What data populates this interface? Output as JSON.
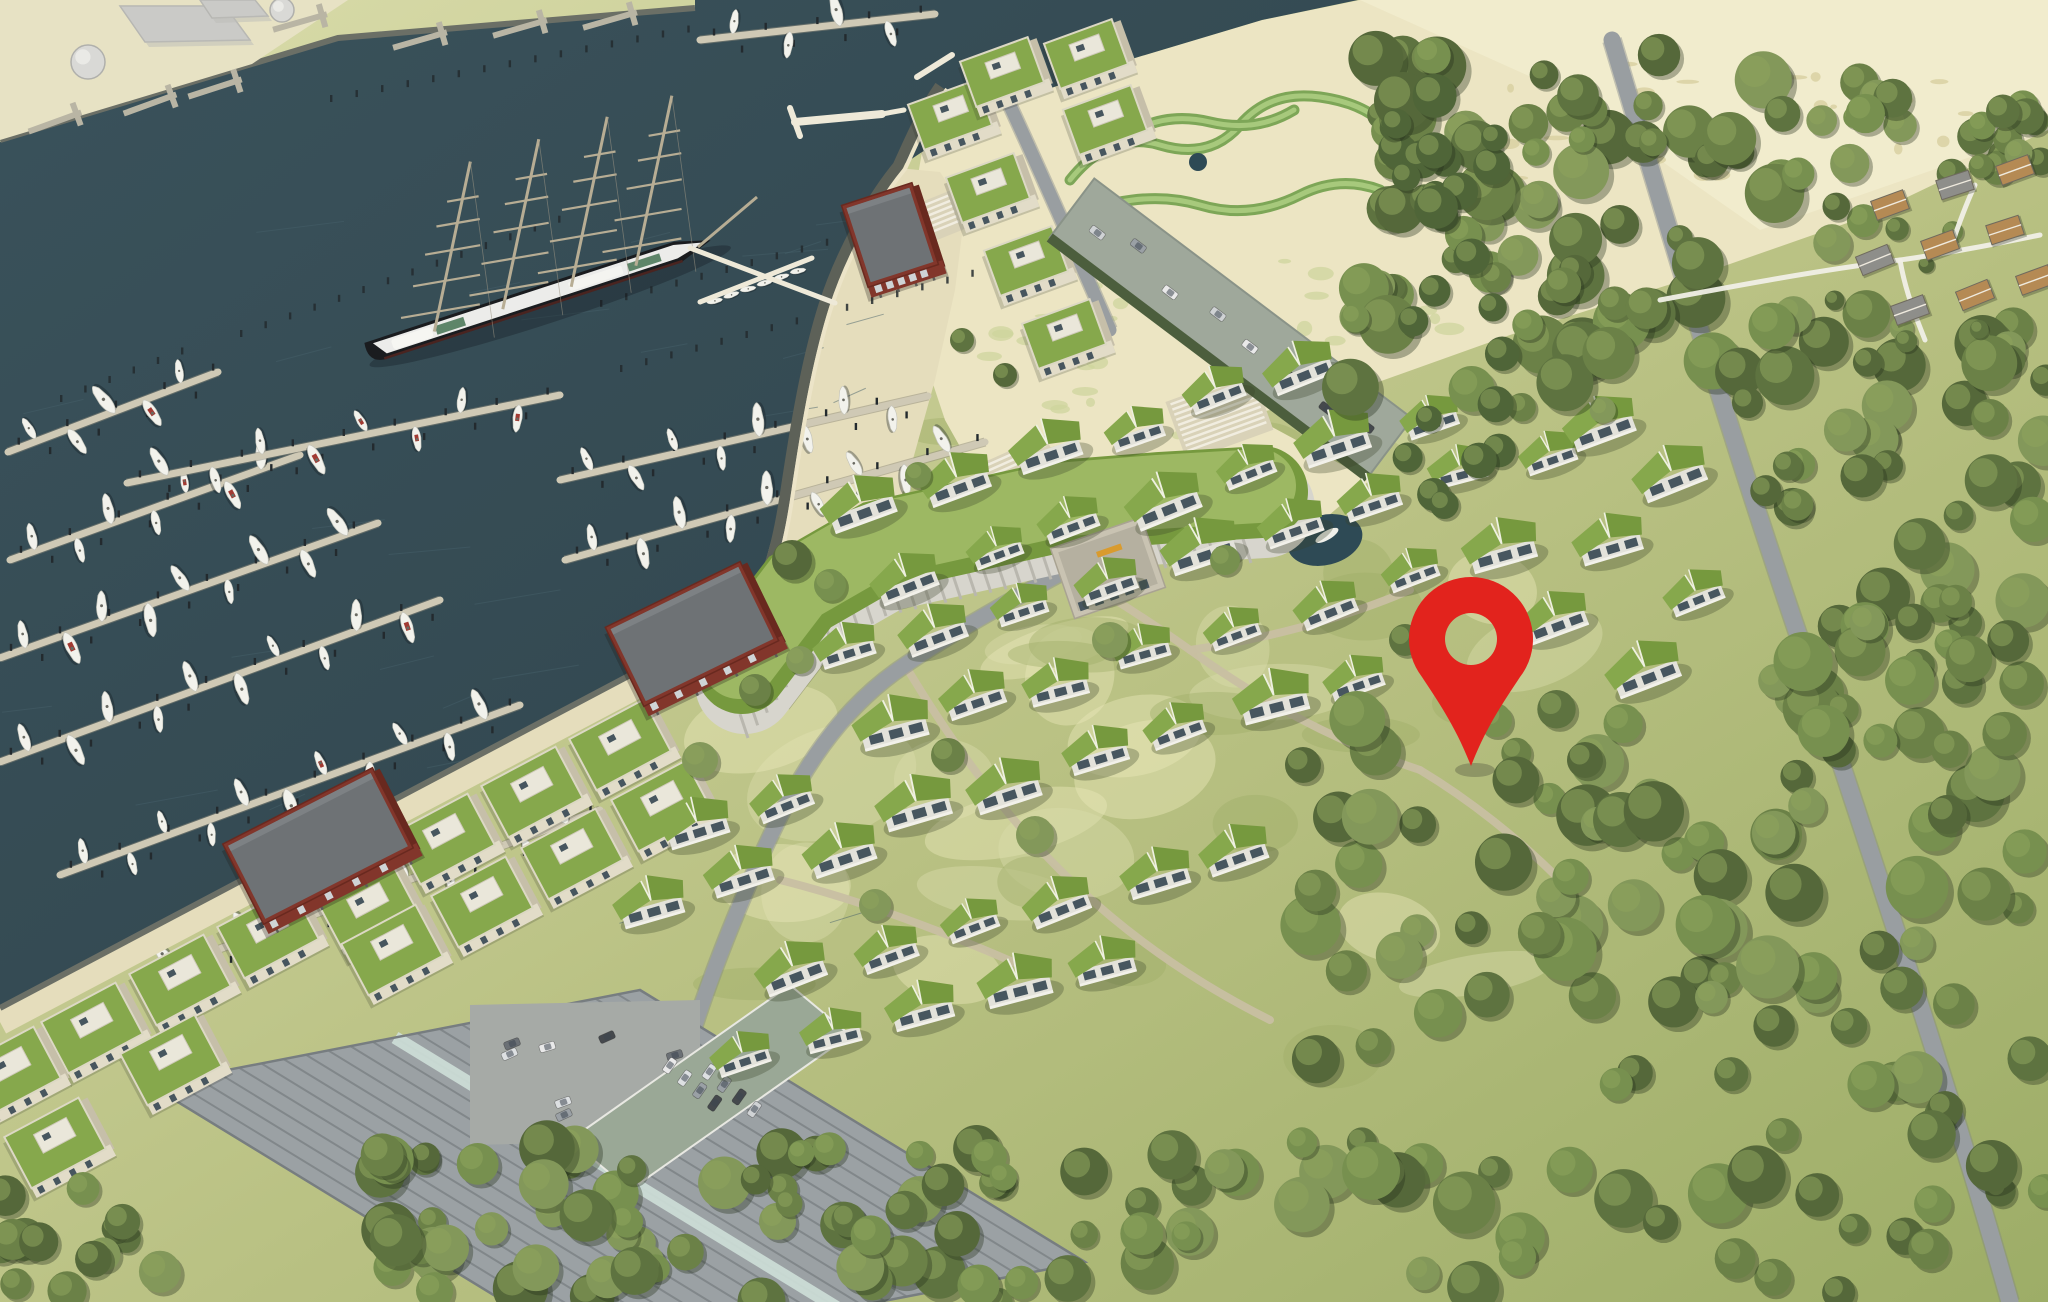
{
  "meta": {
    "canvas": {
      "w": 2048,
      "h": 1302
    },
    "view": "aerial-site-plan-rendering"
  },
  "palette": {
    "water": "#3a525b",
    "water_deep": "#30444c",
    "sand": "#ece5c3",
    "sand_bright": "#f3edcf",
    "quay": "#e7e2c4",
    "meadow": "#b9c183",
    "meadow_light": "#dadcab",
    "meadow_dark": "#9dad67",
    "forest": [
      "#5e7340",
      "#6b8147",
      "#77904f",
      "#55683a",
      "#83985a"
    ],
    "poplar": "#4f6538",
    "roof_green": "#86a84c",
    "roof_green2": "#76993e",
    "wall_front": "#e2dcc8",
    "wall_side": "#c6bfa9",
    "penthouse": "#eae7da",
    "window": "#47565f",
    "brick": "#82362b",
    "brick_dark": "#69291f",
    "brick_roof": "#6e7275",
    "pontoon": "#cfc9b5",
    "pile": "#232a2e",
    "boat": "#f2f2ec",
    "boat_accent": "#a23a32",
    "promenade": "#e5ddbc",
    "seawall": "#5d6158",
    "edge_white": "#ece4c8",
    "road": "#999ea1",
    "path": "#c8bfa2",
    "hall_roof": "#9ba1a4",
    "hall_rib": "#81878a",
    "skylight": "#cfe0d9",
    "lot": "#a6aaa6",
    "deck": "#9aa896",
    "car": [
      "#e9e9e9",
      "#cfd2d4",
      "#9aa0a5",
      "#6b7075",
      "#45494d",
      "#dde0e2"
    ],
    "pin": "#e2231d",
    "ship_hull": "#1a1c1f",
    "ship_deck": "#ececea",
    "ship_green": "#5e8569",
    "mast": "#b7ad94",
    "pond": "#2e4a55",
    "deck_blue": "#5b87a8",
    "deck_blue2": "#8fb6d2",
    "sign": "#d99b2e",
    "tank": "#d9d9d6",
    "cottage_tan": "#b58a54",
    "cottage_gray": "#8e8e8a",
    "white_path": "#f0efe6"
  },
  "scene": {
    "seed": 1337,
    "water_polygon": [
      [
        0,
        142
      ],
      [
        338,
        38
      ],
      [
        695,
        8
      ],
      [
        695,
        0
      ],
      [
        1358,
        0
      ],
      [
        1262,
        20
      ],
      [
        1135,
        58
      ],
      [
        1012,
        102
      ],
      [
        922,
        152
      ],
      [
        898,
        168
      ],
      [
        862,
        216
      ],
      [
        830,
        290
      ],
      [
        808,
        368
      ],
      [
        792,
        442
      ],
      [
        778,
        516
      ],
      [
        760,
        582
      ],
      [
        742,
        614
      ],
      [
        0,
        1008
      ]
    ],
    "quay_polygon": [
      [
        0,
        0
      ],
      [
        348,
        0
      ],
      [
        252,
        64
      ],
      [
        0,
        140
      ]
    ],
    "beach_polygon": [
      [
        905,
        250
      ],
      [
        922,
        152
      ],
      [
        1012,
        102
      ],
      [
        1135,
        58
      ],
      [
        1262,
        20
      ],
      [
        1360,
        0
      ],
      [
        2048,
        0
      ],
      [
        2048,
        130
      ],
      [
        1870,
        215
      ],
      [
        1690,
        278
      ],
      [
        1510,
        335
      ],
      [
        1370,
        385
      ],
      [
        1250,
        415
      ],
      [
        1370,
        480
      ],
      [
        1300,
        540
      ],
      [
        1200,
        560
      ],
      [
        1080,
        540
      ],
      [
        990,
        500
      ],
      [
        945,
        420
      ],
      [
        915,
        330
      ]
    ],
    "plaza_polygon": [
      [
        898,
        168
      ],
      [
        862,
        216
      ],
      [
        830,
        290
      ],
      [
        808,
        368
      ],
      [
        792,
        442
      ],
      [
        778,
        516
      ],
      [
        760,
        582
      ],
      [
        742,
        618
      ],
      [
        830,
        645
      ],
      [
        880,
        560
      ],
      [
        910,
        470
      ],
      [
        935,
        380
      ],
      [
        955,
        290
      ],
      [
        965,
        210
      ],
      [
        940,
        172
      ]
    ],
    "seawall_path": "M940,86 C920,115 910,140 898,166 C870,200 840,255 824,305 C806,362 795,430 786,490 C778,545 768,585 742,616",
    "quay_edge": {
      "x1": 742,
      "y1": 616,
      "x2": 0,
      "y2": 1008
    },
    "top_quay_edge": "M0,140 L338,38 L695,8",
    "pontoons": [
      {
        "x1": 8,
        "y1": 452,
        "x2": 218,
        "y2": 372,
        "boats": 5
      },
      {
        "x1": 10,
        "y1": 560,
        "x2": 300,
        "y2": 455,
        "boats": 7
      },
      {
        "x1": 0,
        "y1": 658,
        "x2": 378,
        "y2": 523,
        "boats": 9
      },
      {
        "x1": 0,
        "y1": 762,
        "x2": 440,
        "y2": 600,
        "boats": 10
      },
      {
        "x1": 60,
        "y1": 875,
        "x2": 520,
        "y2": 705,
        "boats": 11
      },
      {
        "x1": 140,
        "y1": 978,
        "x2": 600,
        "y2": 810,
        "boats": 11
      },
      {
        "x1": 127,
        "y1": 483,
        "x2": 560,
        "y2": 395,
        "boats": 8
      },
      {
        "x1": 560,
        "y1": 480,
        "x2": 928,
        "y2": 396,
        "boats": 8
      },
      {
        "x1": 565,
        "y1": 560,
        "x2": 985,
        "y2": 442,
        "boats": 9
      },
      {
        "x1": 618,
        "y1": 692,
        "x2": 930,
        "y2": 515,
        "boats": 7
      },
      {
        "x1": 700,
        "y1": 40,
        "x2": 935,
        "y2": 14,
        "boats": 4
      }
    ],
    "pile_rows": [
      [
        240,
        330,
        560,
        215
      ],
      [
        600,
        300,
        950,
        205
      ],
      [
        620,
        365,
        1000,
        262
      ],
      [
        60,
        395,
        200,
        340
      ],
      [
        330,
        95,
        690,
        25
      ]
    ],
    "piers": [
      {
        "x1": 795,
        "y1": 122,
        "x2": 882,
        "y2": 114,
        "w": 8
      },
      {
        "x1": 790,
        "y1": 108,
        "x2": 800,
        "y2": 136,
        "w": 6
      },
      {
        "x1": 882,
        "y1": 114,
        "x2": 904,
        "y2": 110,
        "w": 5
      },
      {
        "x1": 917,
        "y1": 77,
        "x2": 952,
        "y2": 55,
        "w": 6
      },
      {
        "x1": 835,
        "y1": 303,
        "x2": 690,
        "y2": 248,
        "w": 5
      },
      {
        "x1": 700,
        "y1": 302,
        "x2": 812,
        "y2": 258,
        "w": 5
      }
    ],
    "quay_docks": [
      [
        55,
        122,
        -20
      ],
      [
        150,
        104,
        -20
      ],
      [
        215,
        88,
        -18
      ],
      [
        300,
        22,
        -16
      ],
      [
        420,
        40,
        -16
      ],
      [
        520,
        28,
        -16
      ],
      [
        610,
        20,
        -16
      ]
    ],
    "ship": {
      "cx": 537,
      "cy": 298,
      "rot": -18.1,
      "len": 360,
      "beam": 26,
      "mast_x": [
        -108,
        -36,
        36,
        104
      ],
      "mast_lean": [
        36,
        -170
      ],
      "yard_fracs": [
        0.12,
        0.3,
        0.48,
        0.64,
        0.78
      ],
      "yard_half": [
        40,
        34,
        28,
        22,
        16
      ],
      "bowsprit": [
        [
          698,
          247
        ],
        [
          757,
          197
        ]
      ]
    },
    "dinghies": {
      "x1": 706,
      "y1": 296,
      "x2": 806,
      "y2": 260,
      "n": 6
    },
    "head_blocks": [
      [
        950,
        115
      ],
      [
        988,
        188
      ],
      [
        1026,
        261
      ],
      [
        1064,
        334
      ],
      [
        1002,
        72
      ],
      [
        1086,
        54
      ],
      [
        1105,
        120
      ]
    ],
    "garage": {
      "a": [
        1072,
        208
      ],
      "b": [
        1390,
        448
      ],
      "w": 74,
      "cars": 8
    },
    "park_ribbons": [
      "M1070,180 q40,-50 90,-35 q50,15 80,-20 q30,-35 80,-28 q50,7 70,35",
      "M1090,210 q60,-20 110,-5 q50,15 100,-10 q40,-20 80,-5",
      "M1120,140 q40,-30 90,-18 q46,11 84,-12"
    ],
    "park_pond": [
      1198,
      162,
      9
    ],
    "hotel": {
      "spine": [
        [
          742,
          668
        ],
        [
          800,
          592
        ],
        [
          880,
          546
        ],
        [
          970,
          526
        ],
        [
          1060,
          506
        ],
        [
          1160,
          498
        ],
        [
          1262,
          492
        ]
      ],
      "tower": {
        "x": 1108,
        "y": 568,
        "w": 96,
        "h": 74,
        "rot": -19
      },
      "sign": {
        "x": 1096,
        "y": 552,
        "w": 26,
        "h": 6,
        "rot": -19
      }
    },
    "pond": {
      "x": 1325,
      "y": 540,
      "rx": 38,
      "ry": 25,
      "rot": -14
    },
    "blue_deck": {
      "x": 1232,
      "y": 542,
      "n": 6,
      "rot": -22
    },
    "stairs": [
      {
        "x": 1010,
        "y": 455,
        "rot": -24,
        "n": 8,
        "len": 72
      },
      {
        "x": 1210,
        "y": 390,
        "rot": -20,
        "n": 10,
        "len": 84
      },
      {
        "x": 925,
        "y": 205,
        "rot": -22,
        "n": 6,
        "len": 50
      }
    ],
    "quay_blocks": [
      [
        620,
        745
      ],
      [
        532,
        792
      ],
      [
        444,
        839
      ],
      [
        368,
        908
      ],
      [
        268,
        933
      ],
      [
        180,
        980
      ],
      [
        92,
        1028
      ],
      [
        10,
        1072
      ],
      [
        662,
        806
      ],
      [
        572,
        854
      ],
      [
        482,
        902
      ],
      [
        392,
        950
      ],
      [
        171,
        1060
      ],
      [
        55,
        1143
      ]
    ],
    "red_buildings": [
      {
        "x": 890,
        "y": 235,
        "w": 74,
        "h": 86,
        "rot": -18,
        "stilts": true
      },
      {
        "x": 692,
        "y": 634,
        "w": 150,
        "h": 88,
        "rot": -26,
        "stilts": true
      },
      {
        "x": 318,
        "y": 846,
        "w": 168,
        "h": 90,
        "rot": -27,
        "stilts": true
      }
    ],
    "hall": {
      "quad": [
        [
          150,
          1085
        ],
        [
          640,
          990
        ],
        [
          1085,
          1262
        ],
        [
          595,
          1357
        ]
      ],
      "ribs": 22
    },
    "parking_lot": {
      "quad": [
        [
          470,
          1005
        ],
        [
          700,
          1000
        ],
        [
          700,
          1140
        ],
        [
          470,
          1145
        ]
      ],
      "cars": 7
    },
    "car_deck": {
      "quad": [
        [
          790,
          985
        ],
        [
          850,
          1035
        ],
        [
          630,
          1190
        ],
        [
          570,
          1140
        ]
      ],
      "cars": 8
    },
    "roads": [
      {
        "d": "M1612,40 C1660,200 1725,420 1800,640 C1870,850 1950,1090 2010,1302",
        "w": 17
      },
      {
        "d": "M1240,475 C1130,540 1000,600 905,665 C830,715 790,790 755,870 C720,950 690,1030 668,1118",
        "w": 15
      },
      {
        "d": "M560,1302 L625,1150 L668,1118",
        "w": 14
      },
      {
        "d": "M1005,95 C1040,170 1075,250 1110,330",
        "w": 13
      }
    ],
    "paths": [
      "M980,520 C1050,560 1120,600 1190,650 C1260,700 1330,740 1420,770",
      "M905,665 C950,740 1000,810 1060,870 C1120,930 1190,980 1270,1020",
      "M780,880 C860,900 940,930 1020,965",
      "M1420,770 C1470,800 1520,840 1560,880",
      "M1190,650 C1260,640 1340,620 1410,590"
    ],
    "villas": [
      [
        866,
        500
      ],
      [
        952,
        474
      ],
      [
        1040,
        452
      ],
      [
        1128,
        424
      ],
      [
        1216,
        396
      ],
      [
        1304,
        370
      ],
      [
        902,
        576
      ],
      [
        988,
        550
      ],
      [
        1076,
        524
      ],
      [
        1164,
        498
      ],
      [
        1252,
        472
      ],
      [
        1340,
        446
      ],
      [
        1428,
        420
      ],
      [
        848,
        652
      ],
      [
        934,
        626
      ],
      [
        1022,
        600
      ],
      [
        1110,
        576
      ],
      [
        1198,
        550
      ],
      [
        1286,
        524
      ],
      [
        1374,
        498
      ],
      [
        1462,
        474
      ],
      [
        1550,
        450
      ],
      [
        884,
        728
      ],
      [
        970,
        702
      ],
      [
        1058,
        678
      ],
      [
        1146,
        652
      ],
      [
        1234,
        626
      ],
      [
        1322,
        600
      ],
      [
        1410,
        576
      ],
      [
        1498,
        550
      ],
      [
        920,
        804
      ],
      [
        1006,
        780
      ],
      [
        1094,
        754
      ],
      [
        1182,
        728
      ],
      [
        1270,
        702
      ],
      [
        1358,
        678
      ],
      [
        700,
        822
      ],
      [
        788,
        798
      ],
      [
        656,
        900
      ],
      [
        744,
        876
      ],
      [
        832,
        852
      ],
      [
        790,
        975
      ],
      [
        880,
        950
      ],
      [
        970,
        925
      ],
      [
        1060,
        900
      ],
      [
        1150,
        875
      ],
      [
        1240,
        850
      ],
      [
        742,
        1056
      ],
      [
        832,
        1030
      ],
      [
        922,
        1005
      ],
      [
        1012,
        980
      ],
      [
        1102,
        955
      ],
      [
        1592,
        424
      ],
      [
        1672,
        470
      ],
      [
        1612,
        546
      ],
      [
        1692,
        592
      ],
      [
        1560,
        622
      ],
      [
        1640,
        668
      ]
    ],
    "single_trees": [
      [
        792,
        560,
        20
      ],
      [
        830,
        585,
        16
      ],
      [
        1110,
        640,
        18
      ],
      [
        948,
        755,
        17
      ],
      [
        1035,
        835,
        19
      ],
      [
        875,
        905,
        16
      ],
      [
        1303,
        765,
        18
      ],
      [
        1225,
        560,
        15
      ],
      [
        1405,
        640,
        16
      ],
      [
        700,
        760,
        18
      ],
      [
        1495,
        720,
        17
      ],
      [
        1585,
        760,
        18
      ],
      [
        755,
        690,
        16
      ],
      [
        800,
        660,
        14
      ],
      [
        918,
        475,
        13
      ],
      [
        962,
        340,
        12
      ],
      [
        1005,
        375,
        12
      ]
    ],
    "tree_regions": [
      {
        "x": 1350,
        "y": 55,
        "w": 520,
        "h": 365,
        "n": 90,
        "rmin": 13,
        "rmax": 30
      },
      {
        "x": 1760,
        "y": 300,
        "w": 288,
        "h": 460,
        "n": 55,
        "rmin": 14,
        "rmax": 30
      },
      {
        "x": 1300,
        "y": 700,
        "w": 748,
        "h": 602,
        "n": 110,
        "rmin": 15,
        "rmax": 32
      },
      {
        "x": 380,
        "y": 1140,
        "w": 950,
        "h": 162,
        "n": 80,
        "rmin": 13,
        "rmax": 28
      },
      {
        "x": 1385,
        "y": 90,
        "w": 120,
        "h": 430,
        "n": 26,
        "rmin": 12,
        "rmax": 22,
        "poplar": true
      },
      {
        "x": 1850,
        "y": 95,
        "w": 198,
        "h": 80,
        "n": 18,
        "rmin": 10,
        "rmax": 20
      },
      {
        "x": 1830,
        "y": 180,
        "w": 218,
        "h": 190,
        "n": 8,
        "rmin": 8,
        "rmax": 14
      },
      {
        "x": 0,
        "y": 1180,
        "w": 160,
        "h": 122,
        "n": 14,
        "rmin": 12,
        "rmax": 24
      }
    ],
    "cottages": [
      [
        1890,
        205,
        -20,
        0
      ],
      [
        1955,
        185,
        -18,
        1
      ],
      [
        2015,
        170,
        -20,
        0
      ],
      [
        1875,
        260,
        -22,
        1
      ],
      [
        1940,
        245,
        -20,
        0
      ],
      [
        2005,
        230,
        -18,
        0
      ],
      [
        1910,
        310,
        -20,
        1
      ],
      [
        1975,
        295,
        -22,
        0
      ],
      [
        2035,
        280,
        -20,
        0
      ]
    ],
    "cottage_paths": [
      "M1660,300 C1740,285 1820,270 1900,260 C1950,253 2000,243 2040,235",
      "M1900,260 C1905,290 1915,315 1925,340",
      "M1950,250 C1960,220 1968,200 1975,185"
    ],
    "industry": {
      "buildings": [
        [
          [
            120,
            6
          ],
          [
            225,
            6
          ],
          [
            250,
            40
          ],
          [
            145,
            42
          ]
        ],
        [
          [
            200,
            0
          ],
          [
            255,
            0
          ],
          [
            268,
            16
          ],
          [
            212,
            18
          ]
        ]
      ],
      "tanks": [
        [
          88,
          62,
          17
        ],
        [
          282,
          10,
          12
        ]
      ]
    },
    "marker": {
      "x": 1471,
      "y_tip": 766,
      "cy": 639,
      "r_outer": 62,
      "r_hole": 26
    }
  }
}
